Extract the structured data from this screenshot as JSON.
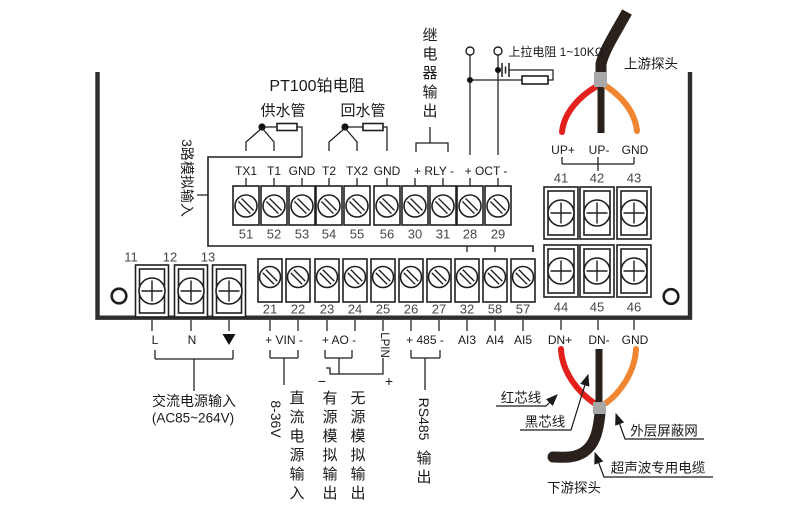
{
  "title": "PT100铂电阻",
  "supply_pipe": "供水管",
  "return_pipe": "回水管",
  "analog_in_label": "3路模拟输入",
  "relay_out_label": "继电器输出",
  "pullup_label": "上拉电阻 1~10KΩ",
  "upstream_probe": "上游探头",
  "downstream_probe": "下游探头",
  "top_terminal_labels": [
    "TX1",
    "T1",
    "GND",
    "T2",
    "TX2",
    "GND"
  ],
  "relay_terminal_label": "+ RLY -",
  "oct_terminal_label": "+ OCT -",
  "terminal_numbers": {
    "sensor_row": [
      "51",
      "52",
      "53",
      "54",
      "55",
      "56",
      "30",
      "31",
      "28",
      "29"
    ],
    "io_row": [
      "21",
      "22",
      "23",
      "24",
      "25",
      "26",
      "27",
      "32",
      "58",
      "57"
    ],
    "power_row": [
      "11",
      "12",
      "13"
    ],
    "upstream_row": [
      "41",
      "42",
      "43"
    ],
    "downstream_row": [
      "44",
      "45",
      "46"
    ]
  },
  "up_labels": [
    "UP+",
    "UP-",
    "GND"
  ],
  "dn_labels": [
    "DN+",
    "DN-",
    "GND"
  ],
  "power_labels": [
    "L",
    "N"
  ],
  "io_labels": {
    "vin": "+ VIN -",
    "ao": "+ AO -",
    "lpin": "LPIN",
    "rs485": "+ 485 -",
    "ai": [
      "AI3",
      "AI4",
      "AI5"
    ]
  },
  "captions": {
    "ac_input": "交流电源输入",
    "ac_range": "(AC85~264V)",
    "dc_range": "8-36V",
    "dc_input": "直流电源输入",
    "active_out": "有源模拟输出",
    "passive_out": "无源模拟输出",
    "passive_minus": "−",
    "passive_plus": "+",
    "rs485_latin": "RS485",
    "rs485_cjk": "输出",
    "red_core": "红芯线",
    "black_core": "黑芯线",
    "shield": "外层屏蔽网",
    "cable": "超声波专用电缆"
  },
  "colors": {
    "red_wire": "#e3201b",
    "orange_wire": "#f08632",
    "black_cable": "#2a211d",
    "ferrule_gray": "#a7a7a7",
    "line": "#1f1f1f"
  }
}
